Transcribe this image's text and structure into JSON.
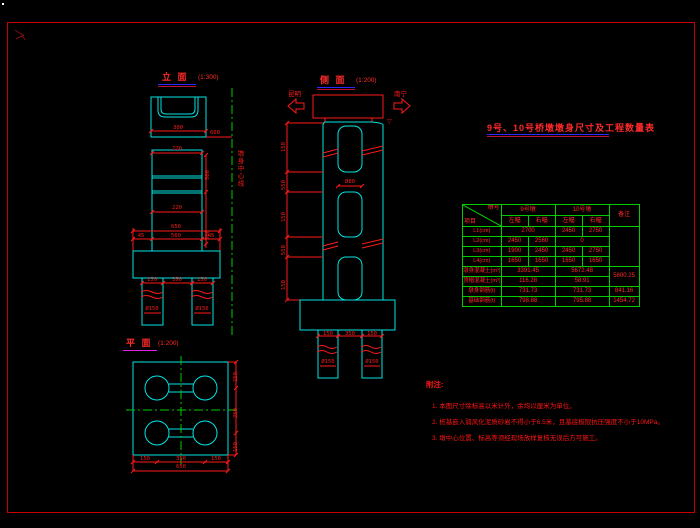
{
  "colors": {
    "line_cyan": "#00e5e5",
    "line_red": "#ff1a1a",
    "grid_green": "#00cc00",
    "underline_blue": "#2a2aff",
    "underline_magenta": "#e020e0",
    "frame_red": "#c80000",
    "background": "#000000"
  },
  "views": {
    "elevation": {
      "label": "立 面",
      "scale": "(1:300)",
      "centerline_label": "墩身中心线",
      "dims": {
        "cap": "300",
        "cap_right": "600",
        "shaft": "220",
        "mid": "220",
        "footing_total": "650",
        "f1": "45",
        "f2": "560",
        "f3": "45",
        "p1": "150",
        "p2": "350",
        "p3": "150",
        "pile_l": "Ø150",
        "pile_r": "Ø150",
        "v1": "500",
        "v2": "500"
      }
    },
    "side": {
      "label": "侧 面",
      "scale": "(1:200)",
      "left_dir": "昆明",
      "right_dir": "南宁",
      "level_mark": "▽",
      "dims": {
        "c1": "150",
        "c2": "550",
        "c3": "150",
        "c4": "550",
        "c5": "150",
        "opening": "Ø80",
        "fp1": "150",
        "fp2": "350",
        "fp3": "150",
        "pile_l": "Ø150",
        "pile_r": "Ø150"
      }
    },
    "plan": {
      "label": "平 面",
      "scale": "(1:200)",
      "dims": {
        "b1": "150",
        "b2": "350",
        "b3": "150",
        "b_total": "650",
        "r1": "150",
        "r2": "350",
        "r3": "150"
      }
    }
  },
  "table": {
    "title": "9号、10号桥墩墩身尺寸及工程数量表",
    "diag_top": "墩号",
    "diag_bottom": "项目",
    "group1": "9号墩",
    "group2": "10号墩",
    "remark_header": "备注",
    "sub1": "左幅",
    "sub2": "右幅",
    "sub3": "左幅",
    "sub4": "右幅",
    "rows": [
      {
        "label": "L1(cm)",
        "a": "2700",
        "b": "2450",
        "c": "2750"
      },
      {
        "label": "L2(cm)",
        "a": "2450",
        "b": "2560",
        "c": "0"
      },
      {
        "label": "L3(cm)",
        "a": "1900",
        "b": "2450",
        "c": "2450",
        "d": "2750"
      },
      {
        "label": "L4(cm)",
        "a": "1650",
        "b": "1650",
        "c": "1650",
        "d": "1650"
      },
      {
        "label": "墩身混凝土(m³)",
        "a": "3391.45",
        "b": "5672.48",
        "remark": "5800.25"
      },
      {
        "label": "顶帽混凝土(m³)",
        "a": "116.28",
        "b": "58.91"
      },
      {
        "label": "墩身钢筋(t)",
        "a": "731.73",
        "b": "731.73",
        "remark": "841.16"
      },
      {
        "label": "基础钢筋(t)",
        "a": "798.88",
        "b": "795.88",
        "remark": "1454.72"
      }
    ]
  },
  "notes": {
    "title": "附注:",
    "items": [
      "1. 本图尺寸除标高以米计外，余均以厘米为单位。",
      "2. 桩基嵌入弱风化泥质砂岩不得小于6.5米，且基底极限抗压强度不小于10MPa。",
      "3. 墩中心位置、标高等须经现场放样复核无误后方可施工。"
    ]
  }
}
